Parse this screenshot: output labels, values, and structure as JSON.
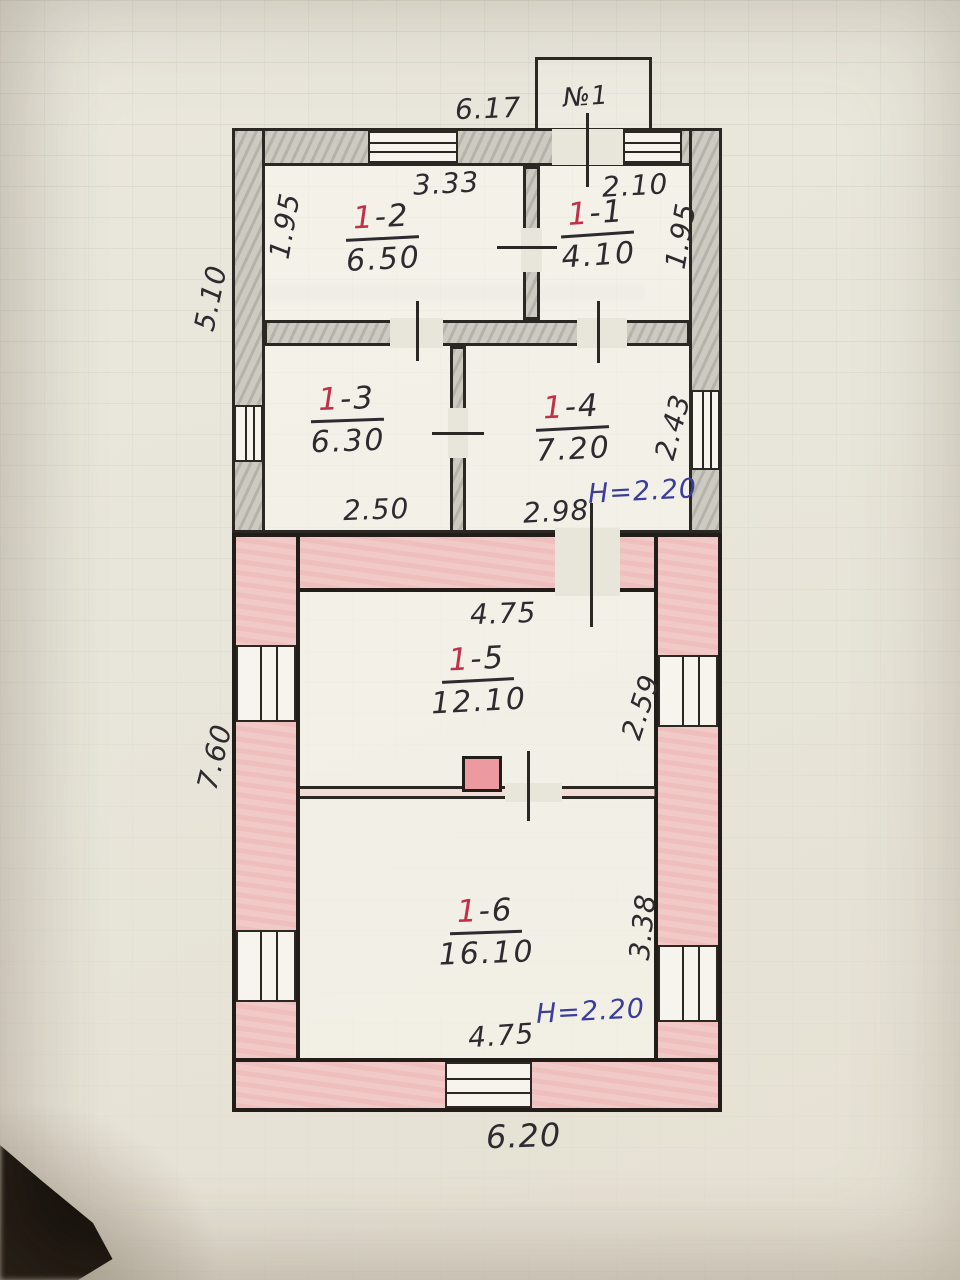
{
  "porch": {
    "label": "№1"
  },
  "heights": {
    "upper": "H=2.20",
    "lower": "H=2.20"
  },
  "rooms": [
    {
      "num": "1",
      "suffix": "-2",
      "area": "6.50"
    },
    {
      "num": "1",
      "suffix": "-1",
      "area": "4.10"
    },
    {
      "num": "1",
      "suffix": "-3",
      "area": "6.30"
    },
    {
      "num": "1",
      "suffix": "-4",
      "area": "7.20"
    },
    {
      "num": "1",
      "suffix": "-5",
      "area": "12.10"
    },
    {
      "num": "1",
      "suffix": "-6",
      "area": "16.10"
    }
  ],
  "dims": {
    "top_width": "6.17",
    "room12_top": "3.33",
    "room11_top": "2.10",
    "left_inner_upper": "1.95",
    "right_inner_upper": "1.95",
    "left_outer_upper": "5.10",
    "room13_bottom": "2.50",
    "room14_bottom": "2.98",
    "room14_right": "2.43",
    "room15_top": "4.75",
    "room15_right": "2.59",
    "left_outer_lower": "7.60",
    "room16_right": "3.38",
    "room16_bottom": "4.75",
    "bottom_width": "6.20"
  },
  "colors": {
    "red_ink": "#c23047",
    "blue_ink": "#3a3d9c",
    "line_ink": "#2b2824",
    "pencil_wall": "#cdcac2",
    "pink_wall": "#f1c9c6",
    "paper": "#e8e5da"
  }
}
